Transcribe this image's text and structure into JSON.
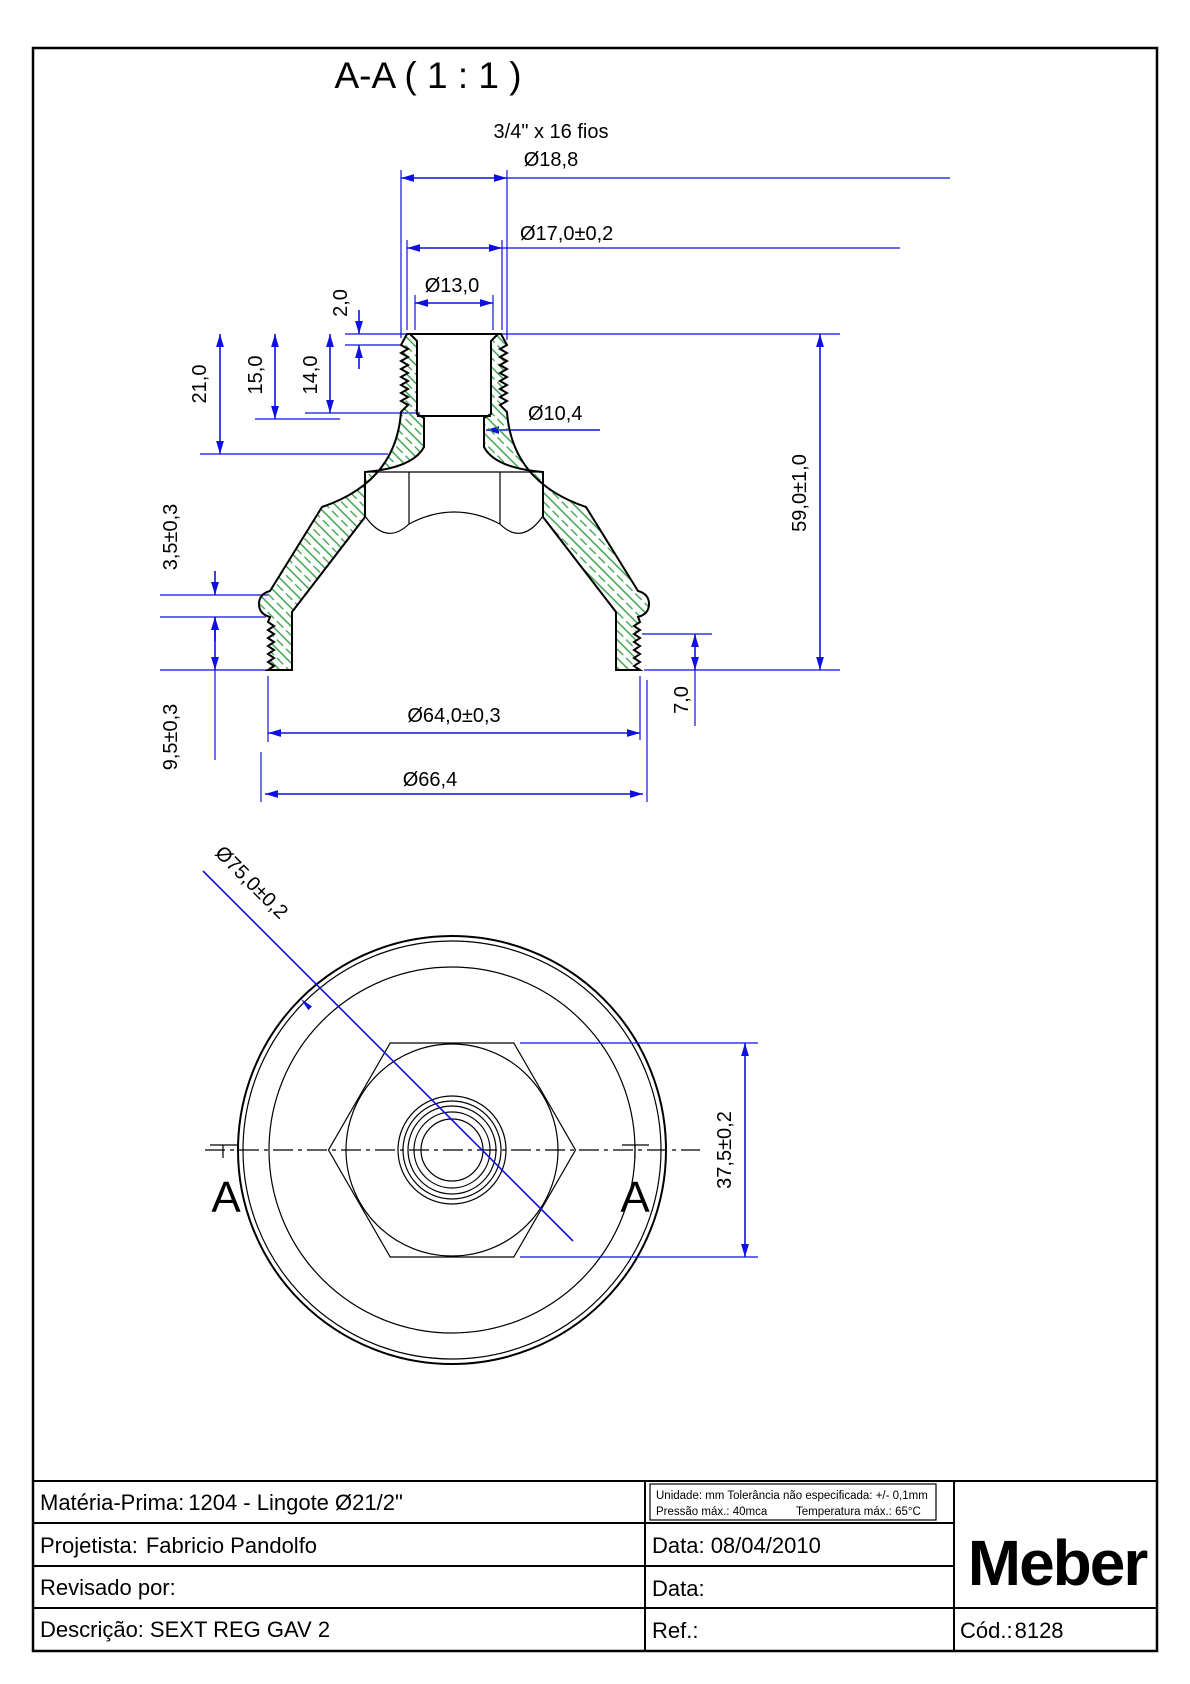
{
  "view_title": "A-A ( 1 : 1 )",
  "colors": {
    "dimension_blue": "#0f10e0",
    "hatch_green": "#2e9e3f",
    "line_black": "#000000"
  },
  "section_view": {
    "thread_spec": "3/4\" x 16 fios",
    "dims": {
      "d_thread_od": "Ø18,8",
      "d_17": "Ø17,0±0,2",
      "d_13": "Ø13,0",
      "h_2": "2,0",
      "h_21": "21,0",
      "h_15": "15,0",
      "h_14": "14,0",
      "d_orifice": "Ø10,4",
      "h_total": "59,0±1,0",
      "h_3_5": "3,5±0,3",
      "h_9_5": "9,5±0,3",
      "h_7": "7,0",
      "d_64": "Ø64,0±0,3",
      "d_66": "Ø66,4"
    }
  },
  "plan_view": {
    "dims": {
      "d_75": "Ø75,0±0,2",
      "w_hex": "37,5±0,2"
    },
    "section_label_left": "A",
    "section_label_right": "A"
  },
  "title_block": {
    "materia": {
      "label": "Matéria-Prima:",
      "value": "1204 - Lingote Ø21/2\""
    },
    "projetista": {
      "label": "Projetista:",
      "value": "Fabricio Pandolfo"
    },
    "revisado": {
      "label": "Revisado por:",
      "value": ""
    },
    "descricao": {
      "label": "Descrição:",
      "value": "SEXT REG GAV 2"
    },
    "notes": {
      "line1": "Unidade: mm Tolerância não especificada: +/- 0,1mm",
      "pressao": "Pressão máx.: 40mca",
      "temperatura": "Temperatura máx.: 65°C"
    },
    "data1": "Data: 08/04/2010",
    "data2": "Data:",
    "ref": "Ref.:",
    "cod": {
      "label": "Cód.:",
      "value": "8128"
    },
    "logo": "Meber"
  }
}
